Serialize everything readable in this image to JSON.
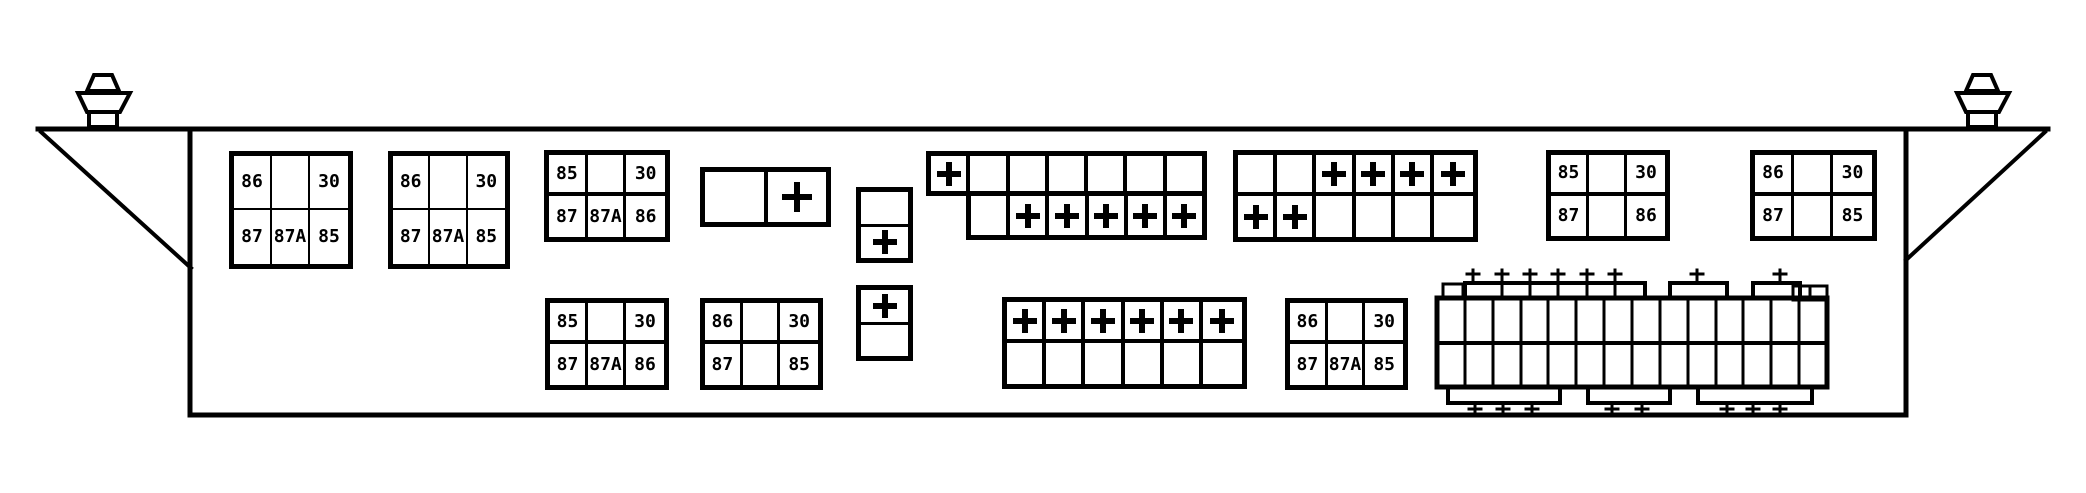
{
  "palette": {
    "line_color": "#000000",
    "background": "#ffffff"
  },
  "icons": {
    "plus_terminal": "plus-cross-terminal",
    "mounting_bolt": "wing-bolt-on-box-edge"
  },
  "relays": [
    {
      "name": "relay-top-left-1",
      "grid": {
        "top": [
          "86",
          "",
          "30"
        ],
        "bottom": [
          "87",
          "87A",
          "85"
        ]
      }
    },
    {
      "name": "relay-top-left-2",
      "grid": {
        "top": [
          "86",
          "",
          "30"
        ],
        "bottom": [
          "87",
          "87A",
          "85"
        ]
      }
    },
    {
      "name": "relay-top-middle",
      "grid": {
        "top": [
          "85",
          "",
          "30"
        ],
        "bottom": [
          "87",
          "87A",
          "86"
        ]
      }
    },
    {
      "name": "relay-top-right-1",
      "grid": {
        "top": [
          "85",
          "",
          "30"
        ],
        "bottom": [
          "87",
          "",
          "86"
        ]
      }
    },
    {
      "name": "relay-top-right-2",
      "grid": {
        "top": [
          "86",
          "",
          "30"
        ],
        "bottom": [
          "87",
          "",
          "85"
        ]
      }
    },
    {
      "name": "relay-bottom-1",
      "grid": {
        "top": [
          "85",
          "",
          "30"
        ],
        "bottom": [
          "87",
          "87A",
          "86"
        ]
      }
    },
    {
      "name": "relay-bottom-2",
      "grid": {
        "top": [
          "86",
          "",
          "30"
        ],
        "bottom": [
          "87",
          "",
          "85"
        ]
      }
    },
    {
      "name": "relay-bottom-3",
      "grid": {
        "top": [
          "86",
          "",
          "30"
        ],
        "bottom": [
          "87",
          "87A",
          "85"
        ]
      }
    }
  ],
  "terminal_strips": {
    "plus_symbol": "+",
    "horizontal_pair": {
      "cells": [
        "",
        "+"
      ]
    },
    "vertical_pair_top": {
      "cells": [
        "",
        "+"
      ]
    },
    "vertical_pair_bottom": {
      "cells": [
        "+",
        ""
      ]
    },
    "top_left_strip": {
      "row1": [
        "+",
        "",
        "",
        "",
        "",
        "",
        ""
      ],
      "row2": [
        "",
        "+",
        "+",
        "+",
        "+",
        "+"
      ]
    },
    "top_right_strip": {
      "row1": [
        "",
        "",
        "+",
        "+",
        "+",
        "+"
      ],
      "row2": [
        "+",
        "+",
        "",
        "",
        "",
        ""
      ]
    },
    "bottom_strip": {
      "row1": [
        "+",
        "+",
        "+",
        "+",
        "+",
        "+"
      ],
      "row2": [
        "",
        "",
        "",
        "",
        "",
        ""
      ]
    }
  }
}
